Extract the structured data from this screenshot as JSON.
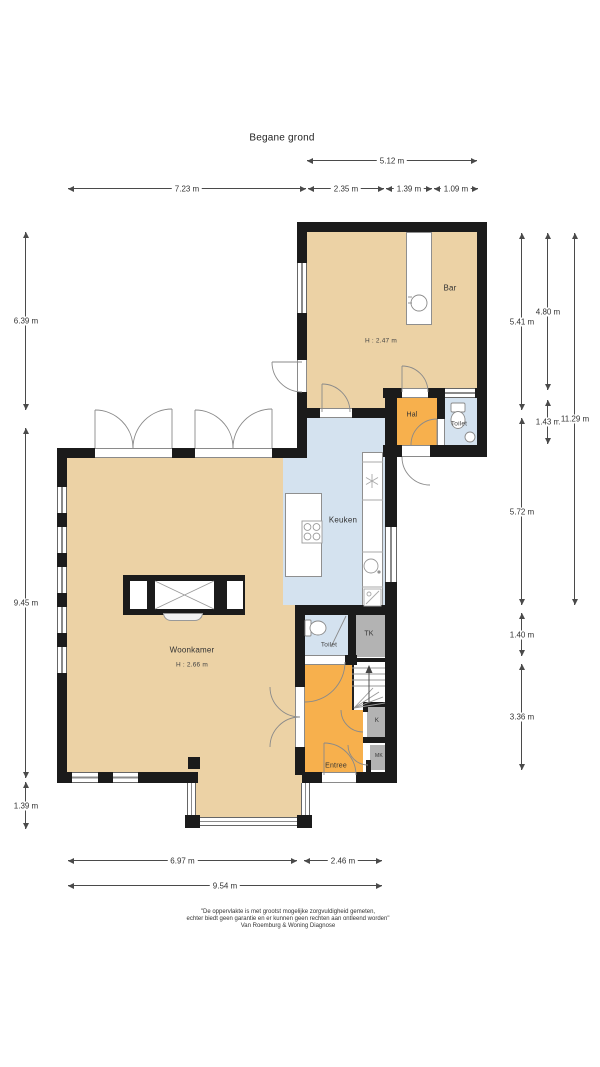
{
  "title": "Begane grond",
  "rooms": {
    "bar": {
      "label": "Bar",
      "ceiling": "H : 2.47 m"
    },
    "hal": {
      "label": "Hal"
    },
    "toilet_top": {
      "label": "Toilet"
    },
    "keuken": {
      "label": "Keuken"
    },
    "woonkamer": {
      "label": "Woonkamer",
      "ceiling": "H : 2.66 m"
    },
    "toilet_bottom": {
      "label": "Toilet"
    },
    "tk": {
      "label": "TK"
    },
    "k": {
      "label": "K"
    },
    "mk": {
      "label": "MK"
    },
    "entree": {
      "label": "Entree"
    }
  },
  "dimensions": {
    "top_upper": [
      {
        "label": "5.12 m"
      }
    ],
    "top_lower": [
      {
        "label": "7.23 m"
      },
      {
        "label": "2.35 m"
      },
      {
        "label": "1.39 m"
      },
      {
        "label": "1.09 m"
      }
    ],
    "left": [
      {
        "label": "6.39 m"
      },
      {
        "label": "9.45 m"
      },
      {
        "label": "1.39 m"
      }
    ],
    "right_inner": [
      {
        "label": "5.41 m"
      },
      {
        "label": "5.72 m"
      },
      {
        "label": "1.40 m"
      },
      {
        "label": "3.36 m"
      }
    ],
    "right_middle": [
      {
        "label": "4.80 m"
      },
      {
        "label": "1.43 m"
      }
    ],
    "right_outer": [
      {
        "label": "11.29 m"
      }
    ],
    "bottom_upper": [
      {
        "label": "6.97 m"
      },
      {
        "label": "2.46 m"
      }
    ],
    "bottom_lower": [
      {
        "label": "9.54 m"
      }
    ]
  },
  "footer": {
    "line1": "\"De oppervlakte is met grootst mogelijke zorgvuldigheid gemeten,",
    "line2": "echter biedt geen garantie en er kunnen geen rechten aan ontleend worden\"",
    "line3": "Van Roemburg & Woning Diagnose"
  },
  "colors": {
    "room_floor": "#ecd2a5",
    "hall_floor": "#f7b04d",
    "wet_room_floor": "#d4e2ef",
    "closet_floor": "#b3b3b3",
    "wall": "#1b1b1b"
  }
}
